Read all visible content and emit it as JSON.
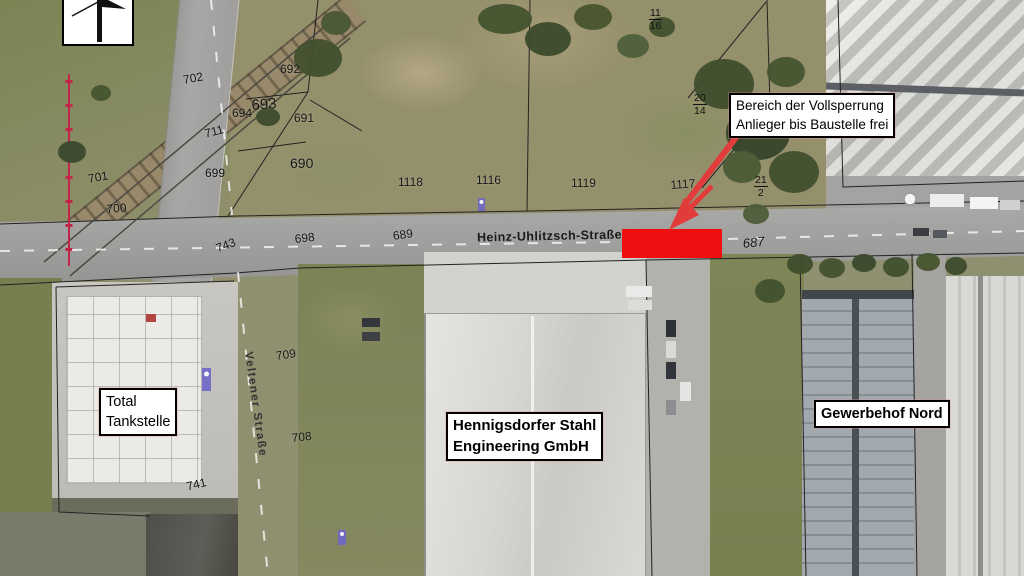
{
  "streets": {
    "heinz": "Heinz-Uhlitzsch-Straße",
    "veltener": "Veltener Straße"
  },
  "callouts": {
    "closure": [
      "Bereich der Vollsperrung",
      "Anlieger bis Baustelle frei"
    ],
    "total": [
      "Total",
      "Tankstelle"
    ],
    "stahl": [
      "Hennigsdorfer Stahl",
      "Engineering GmbH"
    ],
    "gewerbehof": [
      "Gewerbehof Nord"
    ]
  },
  "parcels": [
    {
      "n": "702",
      "x": 182,
      "y": 73,
      "r": -10
    },
    {
      "n": "692",
      "x": 280,
      "y": 62,
      "r": 0
    },
    {
      "n": "693",
      "x": 251,
      "y": 97,
      "r": -4,
      "s": 15
    },
    {
      "n": "694",
      "x": 232,
      "y": 106,
      "r": 0
    },
    {
      "n": "691",
      "x": 294,
      "y": 111,
      "r": 0
    },
    {
      "n": "711",
      "x": 203,
      "y": 127,
      "r": -14
    },
    {
      "n": "690",
      "x": 290,
      "y": 155,
      "r": 0,
      "s": 14
    },
    {
      "n": "699",
      "x": 205,
      "y": 166,
      "r": 0
    },
    {
      "n": "701",
      "x": 87,
      "y": 172,
      "r": -10
    },
    {
      "n": "700",
      "x": 106,
      "y": 202,
      "r": -4
    },
    {
      "n": "743",
      "x": 214,
      "y": 242,
      "r": -20
    },
    {
      "n": "698",
      "x": 294,
      "y": 232,
      "r": -6
    },
    {
      "n": "689",
      "x": 392,
      "y": 229,
      "r": -8
    },
    {
      "n": "1118",
      "x": 398,
      "y": 175,
      "r": 0
    },
    {
      "n": "1116",
      "x": 476,
      "y": 173,
      "r": 0
    },
    {
      "n": "1119",
      "x": 571,
      "y": 176,
      "r": 0
    },
    {
      "n": "1117",
      "x": 670,
      "y": 178,
      "r": -4
    },
    {
      "n": "687",
      "x": 742,
      "y": 236,
      "r": -6,
      "i": true,
      "s": 13
    },
    {
      "n": "709",
      "x": 275,
      "y": 349,
      "r": -8
    },
    {
      "n": "708",
      "x": 291,
      "y": 431,
      "r": -6
    },
    {
      "n": "741",
      "x": 185,
      "y": 480,
      "r": -14
    }
  ],
  "fractions": [
    {
      "top": "11",
      "bottom": "16",
      "x": 649,
      "y": 7
    },
    {
      "top": "20",
      "bottom": "14",
      "x": 693,
      "y": 92
    },
    {
      "top": "21",
      "bottom": "2",
      "x": 754,
      "y": 174
    }
  ],
  "colors": {
    "closure_area": "#ee1010",
    "arrow": "#e23b3b",
    "boundary_line": "#c2254a",
    "label_background": "#ffffff",
    "label_border": "#000000"
  }
}
